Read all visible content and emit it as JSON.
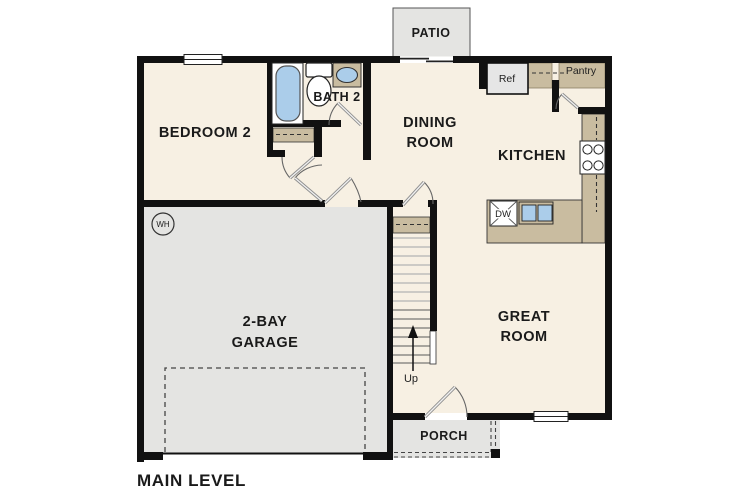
{
  "plan": {
    "title": "MAIN LEVEL",
    "rooms": {
      "patio": {
        "label": "PATIO"
      },
      "bedroom2": {
        "label": "BEDROOM 2"
      },
      "bath2": {
        "label": "BATH 2"
      },
      "dining": {
        "line1": "DINING",
        "line2": "ROOM"
      },
      "kitchen": {
        "label": "KITCHEN"
      },
      "great_room": {
        "line1": "GREAT",
        "line2": "ROOM"
      },
      "garage": {
        "line1": "2-BAY",
        "line2": "GARAGE"
      },
      "porch": {
        "label": "PORCH"
      }
    },
    "annotations": {
      "pantry": "Pantry",
      "refrigerator": "Ref",
      "dishwasher": "DW",
      "water_heater": "WH",
      "stairs_direction": "Up"
    },
    "colors": {
      "floor": "#f7f0e3",
      "hard_surface": "#e4e4e2",
      "cabinetry": "#c9bca0",
      "plumbing_fixture": "#abcdea",
      "wall": "#111111"
    }
  }
}
